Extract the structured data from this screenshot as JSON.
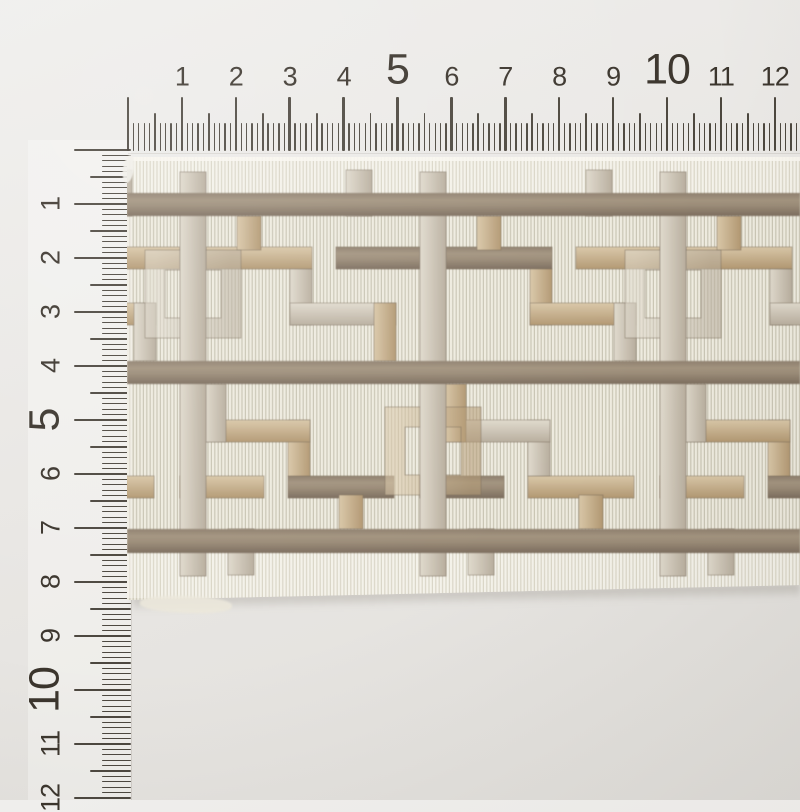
{
  "photo": {
    "background_top": "#efeeec",
    "background_bottom": "#e2e0dc",
    "subject_name": "embroidered-greek-key-trim-tape"
  },
  "top_ruler": {
    "orientation": "horizontal",
    "unit": "cm",
    "origin_x": 128,
    "px_per_mm": 5.39,
    "tick_bottom_y": 151,
    "mm_tick_count": 125,
    "tick_color": "#3e3830",
    "number_color": "#3b352d",
    "tick_lengths": {
      "cm": 54,
      "half": 38,
      "mm": 28
    },
    "tick_widths": {
      "cm": 2.6,
      "half": 1.8,
      "mm": 1.3
    },
    "number_center_y_small": 77,
    "number_center_y_big": 70,
    "font_size_small": 27,
    "font_size_big": 43,
    "numbers": [
      {
        "value": "1",
        "big": false
      },
      {
        "value": "2",
        "big": false
      },
      {
        "value": "3",
        "big": false
      },
      {
        "value": "4",
        "big": false
      },
      {
        "value": "5",
        "big": true
      },
      {
        "value": "6",
        "big": false
      },
      {
        "value": "7",
        "big": false
      },
      {
        "value": "8",
        "big": false
      },
      {
        "value": "9",
        "big": false
      },
      {
        "value": "10",
        "big": true
      },
      {
        "value": "11",
        "big": false
      },
      {
        "value": "12",
        "big": false
      }
    ]
  },
  "left_ruler": {
    "orientation": "vertical",
    "unit": "cm",
    "origin_y": 150,
    "px_per_mm": 5.4,
    "tick_right_x": 131,
    "mm_tick_count": 121,
    "tick_color": "#3e3830",
    "number_color": "#3b352d",
    "tick_lengths": {
      "cm": 57,
      "half": 41,
      "mm": 29
    },
    "tick_widths": {
      "cm": 2.6,
      "half": 1.8,
      "mm": 1.3
    },
    "number_center_x_small": 51,
    "number_center_x_big": 45,
    "font_size_small": 27,
    "font_size_big": 43,
    "number_rotation_deg": -90,
    "numbers": [
      {
        "value": "1",
        "big": false
      },
      {
        "value": "2",
        "big": false
      },
      {
        "value": "3",
        "big": false
      },
      {
        "value": "4",
        "big": false
      },
      {
        "value": "5",
        "big": true
      },
      {
        "value": "6",
        "big": false
      },
      {
        "value": "7",
        "big": false
      },
      {
        "value": "8",
        "big": false
      },
      {
        "value": "9",
        "big": false
      },
      {
        "value": "10",
        "big": true
      },
      {
        "value": "11",
        "big": false
      },
      {
        "value": "12",
        "big": false
      }
    ]
  },
  "trim": {
    "left": 127,
    "top": 157,
    "width": 673,
    "height": 443,
    "colors": {
      "ground": "#eeebdf",
      "ground_rib": "#c9c5b4",
      "selvedge": "#f4f2ea",
      "selvedge_rib": "#dad6c7",
      "edge_white": "#f8f6ef",
      "taupe_dark": "#7c6d5e",
      "taupe": "#9a8b77",
      "taupe_light": "#a3947f",
      "tan_light": "#d9c7a8",
      "tan": "#b29872",
      "silver_light": "#e0dacd",
      "silver": "#b8ae9e",
      "outline": "#776855"
    },
    "bands": {
      "selvedge_top": [
        0,
        36
      ],
      "bar1": [
        36,
        59
      ],
      "field1": [
        59,
        204
      ],
      "bar2": [
        204,
        227
      ],
      "field2": [
        227,
        372
      ],
      "bar3": [
        372,
        396
      ],
      "selvedge_bottom": [
        396,
        441
      ]
    },
    "pattern": {
      "unit_w": 240,
      "first_bar_x": 53,
      "bar_w": 26,
      "full_bar_y": [
        15,
        419
      ],
      "row2_mirror_y_sum": 431,
      "shapes_row1": [
        {
          "name": "rail",
          "rect": [
            26,
            90,
            106,
            22
          ],
          "fill_even": "gTanH",
          "fill_odd": "gTaupe"
        },
        {
          "name": "rail-2",
          "rect": [
            156,
            90,
            84,
            22
          ],
          "fill_even": "gTaupe",
          "fill_odd": "gTanH"
        },
        {
          "name": "step-vert",
          "rect": [
            110,
            112,
            22,
            56
          ],
          "fill_even": "gSilV",
          "fill_odd": "gTanV"
        },
        {
          "name": "step-horiz",
          "rect": [
            110,
            146,
            106,
            22
          ],
          "fill_even": "gSilH",
          "fill_odd": "gTanH"
        },
        {
          "name": "step-vert-2",
          "rect": [
            194,
            146,
            22,
            58
          ],
          "fill_even": "gTanV",
          "fill_odd": "gSilV"
        },
        {
          "name": "hanging-tab",
          "rect": [
            57,
            59,
            24,
            34
          ],
          "fill_even": "gTanV",
          "fill_odd": "gTanV"
        },
        {
          "name": "band-tab",
          "rect": [
            166,
            13,
            26,
            46
          ],
          "fill_even": "gSilV",
          "fill_odd": "gSilV"
        }
      ],
      "square": {
        "outer": [
          -35,
          93,
          96,
          88
        ],
        "stroke_w": 20,
        "fill_row1": "gSilV",
        "fill_row2": "gTanV"
      }
    }
  }
}
